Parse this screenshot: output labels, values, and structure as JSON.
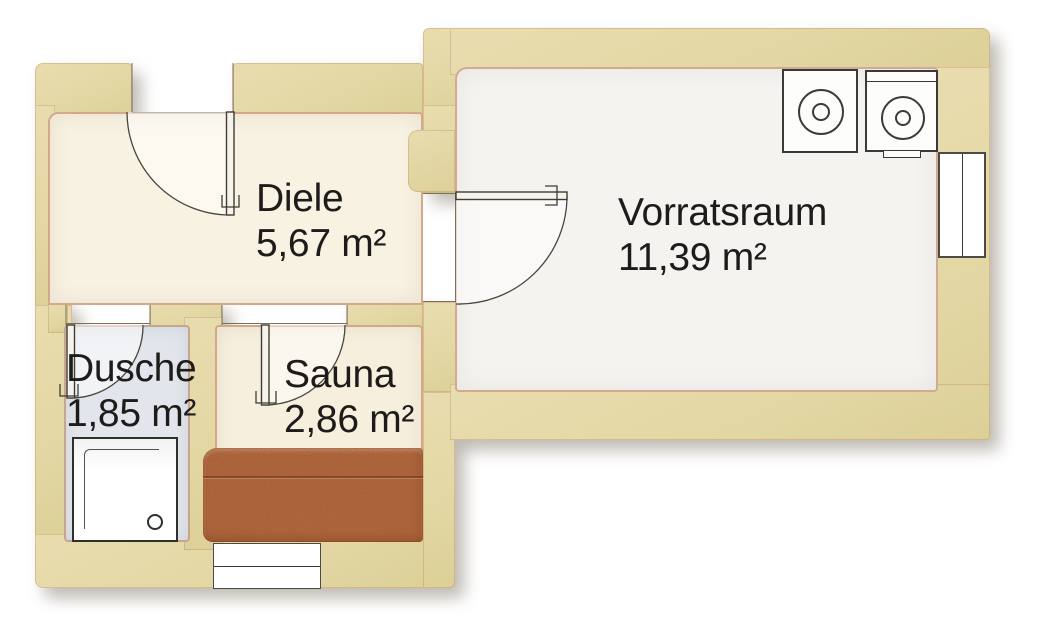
{
  "rooms": [
    {
      "id": "diele",
      "name": "Diele",
      "area": "5,67 m²"
    },
    {
      "id": "vorratsraum",
      "name": "Vorratsraum",
      "area": "11,39 m²"
    },
    {
      "id": "dusche",
      "name": "Dusche",
      "area": "1,85 m²"
    },
    {
      "id": "sauna",
      "name": "Sauna",
      "area": "2,86 m²"
    }
  ],
  "doors": [
    "entrance-door",
    "vorratsraum-door",
    "dusche-door",
    "sauna-door"
  ],
  "fixtures": [
    "washing-machine",
    "dryer",
    "window-right-wall",
    "window-bottom-wall",
    "shower-tray",
    "drain",
    "sauna-bench"
  ],
  "colors": {
    "wall": "#e3d7a4",
    "wall_edge": "#b2714a",
    "floor_diele": "#f8f2e3",
    "floor_vorratsraum": "#f5f3f0",
    "floor_dusche": "#e2e6ec",
    "floor_sauna": "#f6efdd",
    "bench": "#b2673e",
    "line": "#44413a"
  }
}
